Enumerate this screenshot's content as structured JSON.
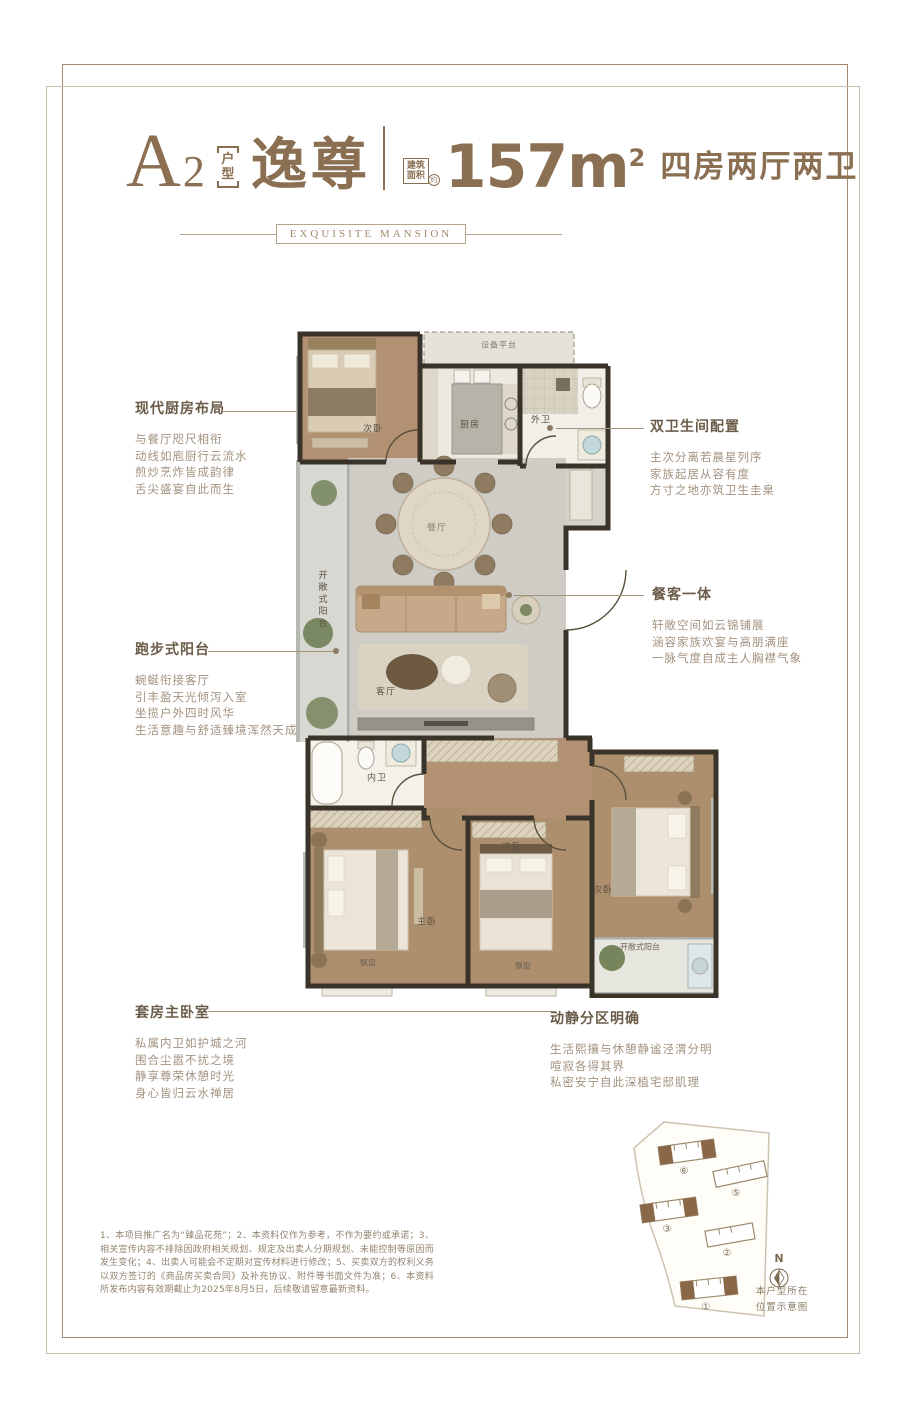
{
  "header": {
    "unit_code_letter": "A",
    "unit_code_number": "2",
    "unit_tag_top": "户",
    "unit_tag_bottom": "型",
    "unit_name": "逸尊",
    "area_badge_line1": "建筑",
    "area_badge_line2": "面积",
    "area_badge_approx": "约",
    "area_value": "157m",
    "area_exponent": "2",
    "rooms_desc": "四房两厅两卫",
    "subtitle": "EXQUISITE MANSION"
  },
  "floorplan": {
    "labels": {
      "equipment_platform": "设备平台",
      "bedroom_top": "次卧",
      "kitchen": "厨房",
      "bath_outer": "外卫",
      "balcony_left": "开敞式阳台",
      "dining": "餐厅",
      "living": "客厅",
      "bath_inner": "内卫",
      "master_bedroom": "主卧",
      "bedroom_mid": "次卧",
      "bedroom_right": "次卧",
      "balcony_bottom": "开敞式阳台",
      "bay_window_1": "飘窗",
      "bay_window_2": "飘窗"
    }
  },
  "callouts": {
    "kitchen": {
      "title": "现代厨房布局",
      "lines": [
        "与餐厅咫尺相衔",
        "动线如庖厨行云流水",
        "煎炒烹炸皆成韵律",
        "舌尖盛宴自此而生"
      ]
    },
    "bathrooms": {
      "title": "双卫生间配置",
      "lines": [
        "主次分离若晨星列序",
        "家族起居从容有度",
        "方寸之地亦筑卫生圭臬"
      ]
    },
    "dining_living": {
      "title": "餐客一体",
      "lines": [
        "轩敞空间如云锦铺展",
        "涵容家族欢宴与高朋满座",
        "一脉气度自成主人胸襟气象"
      ]
    },
    "balcony": {
      "title": "跑步式阳台",
      "lines": [
        "蜿蜒衔接客厅",
        "引丰盈天光倾泻入室",
        "坐揽户外四时风华",
        "生活意趣与舒适臻境浑然天成"
      ]
    },
    "master_suite": {
      "title": "套房主卧室",
      "lines": [
        "私属内卫如护城之河",
        "围合尘嚣不扰之境",
        "静享尊荣休憩时光",
        "身心皆归云水禅居"
      ]
    },
    "zoning": {
      "title": "动静分区明确",
      "lines": [
        "生活熙攘与休憩静谧泾渭分明",
        "喧寂各得其界",
        "私密安宁自此深植宅邸肌理"
      ]
    }
  },
  "disclaimer": "1、本项目推广名为“臻品花苑”；2、本资料仅作为参考，不作为要约或承诺；3、相关宣传内容不排除因政府相关规划、规定及出卖人分期规划、未能控制等原因而发生变化；4、出卖人可能会不定期对宣传材料进行修改；5、买卖双方的权利义务以双方签订的《商品房买卖合同》及补充协议、附件等书面文件为准；6、本资料所发布内容有效期截止为2025年8月5日，后续敬请留意最新资料。",
  "siteplan": {
    "compass": "N",
    "caption_line1": "本户型所在",
    "caption_line2": "位置示意图",
    "buildings": [
      {
        "no": "①",
        "highlighted": true
      },
      {
        "no": "②",
        "highlighted": false
      },
      {
        "no": "③",
        "highlighted": true
      },
      {
        "no": "⑤",
        "highlighted": false
      },
      {
        "no": "⑥",
        "highlighted": true
      }
    ]
  },
  "colors": {
    "accent": "#8a6f52",
    "wall": "#39332a",
    "wood_floor": "#ad8f6e",
    "highlight_building": "#8a6847"
  }
}
